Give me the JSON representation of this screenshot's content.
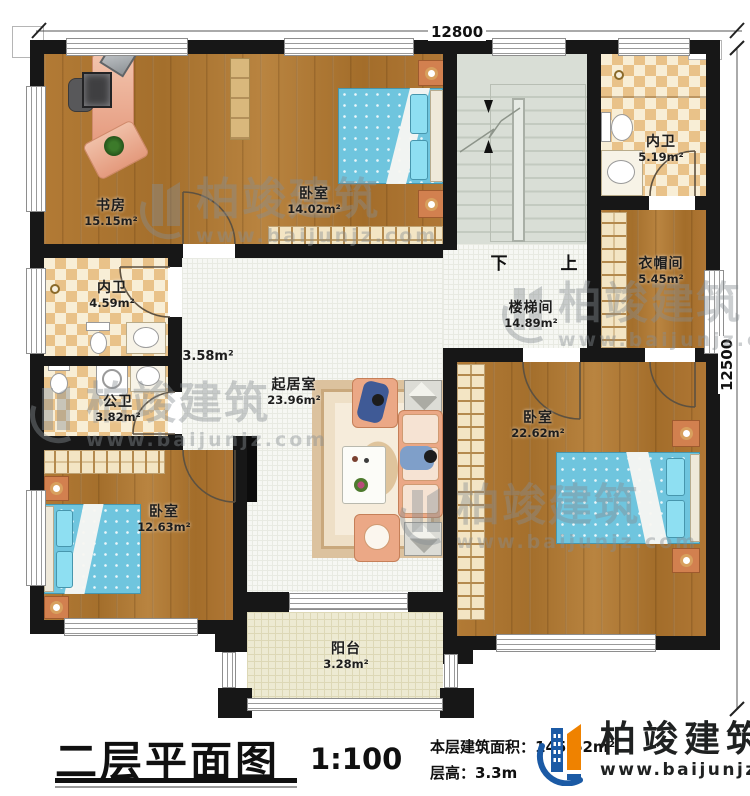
{
  "dimensions": {
    "width_label": "12800",
    "height_label": "12500"
  },
  "rooms": [
    {
      "id": "study",
      "name": "书房",
      "area": "15.15m²"
    },
    {
      "id": "bedroom-top",
      "name": "卧室",
      "area": "14.02m²"
    },
    {
      "id": "bath-top-right",
      "name": "内卫",
      "area": "5.19m²"
    },
    {
      "id": "cloakroom",
      "name": "衣帽间",
      "area": "5.45m²"
    },
    {
      "id": "stairwell",
      "name": "楼梯间",
      "area": "14.89m²"
    },
    {
      "id": "bath-mid-left",
      "name": "内卫",
      "area": "4.59m²"
    },
    {
      "id": "bath-public",
      "name": "公卫",
      "area": "3.82m²"
    },
    {
      "id": "hallway",
      "name": "",
      "area": "3.58m²"
    },
    {
      "id": "living-room",
      "name": "起居室",
      "area": "23.96m²"
    },
    {
      "id": "bedroom-right",
      "name": "卧室",
      "area": "22.62m²"
    },
    {
      "id": "bedroom-left",
      "name": "卧室",
      "area": "12.63m²"
    },
    {
      "id": "balcony",
      "name": "阳台",
      "area": "3.28m²"
    }
  ],
  "stairs": {
    "down_label": "下",
    "up_label": "上"
  },
  "title_block": {
    "title": "二层平面图",
    "scale": "1:100",
    "floor_area_label": "本层建筑面积：",
    "floor_area_value": "145.62m²",
    "floor_height_label": "层高：",
    "floor_height_value": "3.3m"
  },
  "brand": {
    "name": "柏竣建筑",
    "website": "www.baijunjz.com"
  },
  "watermark": {
    "name": "柏竣建筑",
    "website": "www.baijunjz.com"
  },
  "colors": {
    "wall": "#171717",
    "wood": "#ab7531",
    "bath_checker": "#e9c289",
    "tile": "#f6f7f3",
    "stair": "#d9ded6",
    "balcony": "#edead2",
    "bed": "#6fc5de",
    "sofa": "#eba886",
    "brand_blue": "#1b5aa5",
    "brand_orange": "#ef8200"
  }
}
